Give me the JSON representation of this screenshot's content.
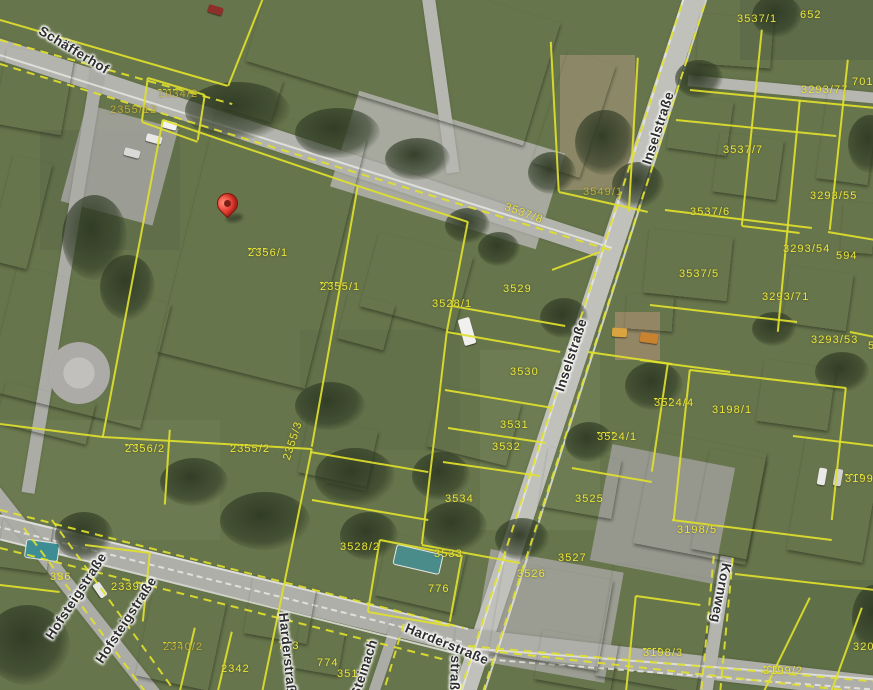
{
  "map": {
    "type": "aerial-cadastral-map",
    "marker": {
      "label": "selected-location",
      "tip_x": 228,
      "tip_y": 220
    },
    "colors": {
      "parcel_line": "#e0e02c",
      "parcel_text": "#eae53c",
      "street_text": "#2e2e2e",
      "street_halo": "#ffffff",
      "marker_red": "#ea4335",
      "grass": "#67754c",
      "asphalt": "#b2b2ad"
    },
    "street_labels": [
      {
        "text": "Schäfferhof",
        "x": 74,
        "y": 50,
        "rot": 31
      },
      {
        "text": "Inselstraße",
        "x": 658,
        "y": 128,
        "rot": -72
      },
      {
        "text": "Inselstraße",
        "x": 571,
        "y": 355,
        "rot": -72
      },
      {
        "text": "Harderstraße",
        "x": 447,
        "y": 644,
        "rot": 22
      },
      {
        "text": "Harderstraße",
        "x": 288,
        "y": 657,
        "rot": 84
      },
      {
        "text": "Hofsteigstraße",
        "x": 76,
        "y": 596,
        "rot": -57
      },
      {
        "text": "Hofsteigstraße",
        "x": 126,
        "y": 620,
        "rot": -57
      },
      {
        "text": "Kornweg",
        "x": 721,
        "y": 593,
        "rot": 101
      },
      {
        "text": "Steinach",
        "x": 364,
        "y": 668,
        "rot": -72
      },
      {
        "text": "straße",
        "x": 455,
        "y": 677,
        "rot": 92
      }
    ],
    "parcel_labels": [
      {
        "text": "1034/2",
        "x": 158,
        "y": 88,
        "ticks": true,
        "dim": true
      },
      {
        "text": "2355/12",
        "x": 110,
        "y": 104,
        "dim": true
      },
      {
        "text": "3537/1",
        "x": 737,
        "y": 13
      },
      {
        "text": "652",
        "x": 800,
        "y": 9
      },
      {
        "text": "3293/77",
        "x": 801,
        "y": 84
      },
      {
        "text": "701",
        "x": 852,
        "y": 76
      },
      {
        "text": "2356/1",
        "x": 248,
        "y": 247,
        "ticks": true
      },
      {
        "text": "2355/1",
        "x": 320,
        "y": 281,
        "ticks": true
      },
      {
        "text": "3537/8",
        "x": 507,
        "y": 201,
        "rot": 20
      },
      {
        "text": "3549/1",
        "x": 583,
        "y": 186,
        "dim": true
      },
      {
        "text": "3528/1",
        "x": 432,
        "y": 298
      },
      {
        "text": "3529",
        "x": 503,
        "y": 283
      },
      {
        "text": "3537/7",
        "x": 723,
        "y": 144
      },
      {
        "text": "3293/55",
        "x": 810,
        "y": 190
      },
      {
        "text": "3537/6",
        "x": 690,
        "y": 206
      },
      {
        "text": "3293/54",
        "x": 783,
        "y": 243
      },
      {
        "text": "594",
        "x": 836,
        "y": 250
      },
      {
        "text": "3537/5",
        "x": 679,
        "y": 268
      },
      {
        "text": "3293/71",
        "x": 762,
        "y": 291
      },
      {
        "text": "3293/53",
        "x": 811,
        "y": 334
      },
      {
        "text": "53",
        "x": 868,
        "y": 340
      },
      {
        "text": "3530",
        "x": 510,
        "y": 366
      },
      {
        "text": "3531",
        "x": 500,
        "y": 419
      },
      {
        "text": "3532",
        "x": 492,
        "y": 441
      },
      {
        "text": "3524/4",
        "x": 654,
        "y": 397,
        "ticks": true
      },
      {
        "text": "3198/1",
        "x": 712,
        "y": 404
      },
      {
        "text": "3524/1",
        "x": 597,
        "y": 431,
        "ticks": true
      },
      {
        "text": "2356/2",
        "x": 125,
        "y": 443,
        "ticks": true
      },
      {
        "text": "2355/2",
        "x": 230,
        "y": 443,
        "ticks": true
      },
      {
        "text": "2355/3",
        "x": 281,
        "y": 458,
        "rot": -72
      },
      {
        "text": "3534",
        "x": 445,
        "y": 493
      },
      {
        "text": "3525",
        "x": 575,
        "y": 493
      },
      {
        "text": "3199/1",
        "x": 845,
        "y": 473,
        "ticks": true
      },
      {
        "text": "3198/5",
        "x": 677,
        "y": 524
      },
      {
        "text": "3528/2",
        "x": 340,
        "y": 541
      },
      {
        "text": "3533",
        "x": 434,
        "y": 548
      },
      {
        "text": "3527",
        "x": 558,
        "y": 552
      },
      {
        "text": "3526",
        "x": 517,
        "y": 568
      },
      {
        "text": "776",
        "x": 428,
        "y": 583
      },
      {
        "text": "336",
        "x": 50,
        "y": 571
      },
      {
        "text": "2339/1",
        "x": 111,
        "y": 581
      },
      {
        "text": "2340/2",
        "x": 163,
        "y": 641,
        "ticks": true,
        "dim": true
      },
      {
        "text": "2342",
        "x": 221,
        "y": 663
      },
      {
        "text": "773",
        "x": 278,
        "y": 640
      },
      {
        "text": "774",
        "x": 317,
        "y": 657
      },
      {
        "text": "3513",
        "x": 337,
        "y": 668
      },
      {
        "text": "3198/3",
        "x": 643,
        "y": 647,
        "ticks": true
      },
      {
        "text": "3199/2",
        "x": 763,
        "y": 665,
        "ticks": true
      },
      {
        "text": "3201/2",
        "x": 853,
        "y": 641
      }
    ]
  }
}
